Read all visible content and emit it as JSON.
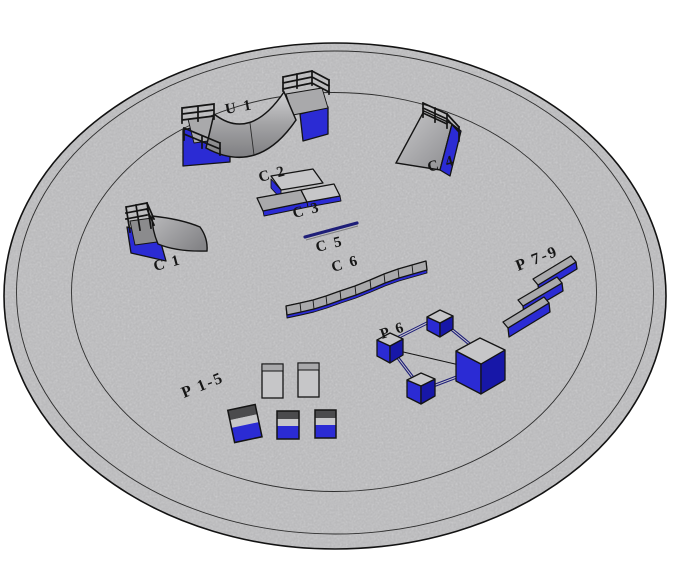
{
  "labels": {
    "u1": "U 1",
    "c1": "C 1",
    "c2": "C 2",
    "c3": "C 3",
    "c4": "C 4",
    "c5": "C 5",
    "c6": "C 6",
    "p15": "P 1-5",
    "p6": "P 6",
    "p79": "P 7-9"
  },
  "colors": {
    "ramp_blue": "#2b2bd4",
    "ramp_blue_dark": "#1717a8",
    "rail_navy": "#1e1e78",
    "surface_gray": "#a9a9ab",
    "surface_gray_light": "#c6c6c8",
    "surface_gray_dark": "#8b8b8d",
    "cube_top_gray": "#4b4b4d",
    "ground_gray": "#d4d4d6",
    "outline": "#141414",
    "background": "#ffffff"
  }
}
